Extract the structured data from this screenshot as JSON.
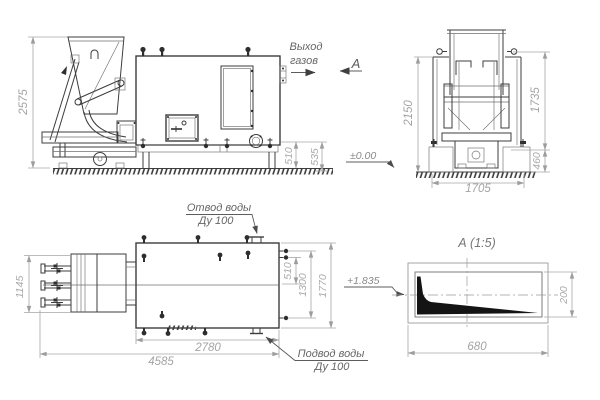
{
  "front_view": {
    "dim_height": "2575",
    "dim_foot_1": "510",
    "dim_foot_2": "535"
  },
  "annotations": {
    "gas_outlet_line1": "Выход",
    "gas_outlet_line2": "газов",
    "section_label": "А"
  },
  "end_view": {
    "dim_height_left": "2150",
    "dim_height_right": "1735",
    "dim_foundation": "460",
    "dim_width": "1705",
    "level_mark": "±0.00"
  },
  "plan_view": {
    "dim_feeder_width": "1145",
    "dim_length_total": "4585",
    "dim_length_body": "2780",
    "dim_right_1": "510",
    "dim_right_2": "1300",
    "dim_right_3": "1770",
    "level_mark": "+1.835",
    "water_outlet_line1": "Отвод воды",
    "water_outlet_line2": "Ду 100",
    "water_inlet_line1": "Подвод воды",
    "water_inlet_line2": "Ду 100"
  },
  "detail_view": {
    "title": "А  (1:5)",
    "dim_width": "680",
    "dim_height": "200"
  },
  "colors": {
    "background": "#ffffff",
    "machine_line": "#3d3d3d",
    "dimension_line": "#a6a6a6",
    "dimension_text": "#aaaaaa",
    "label_text": "#666666",
    "solid_fill": "#141414"
  }
}
